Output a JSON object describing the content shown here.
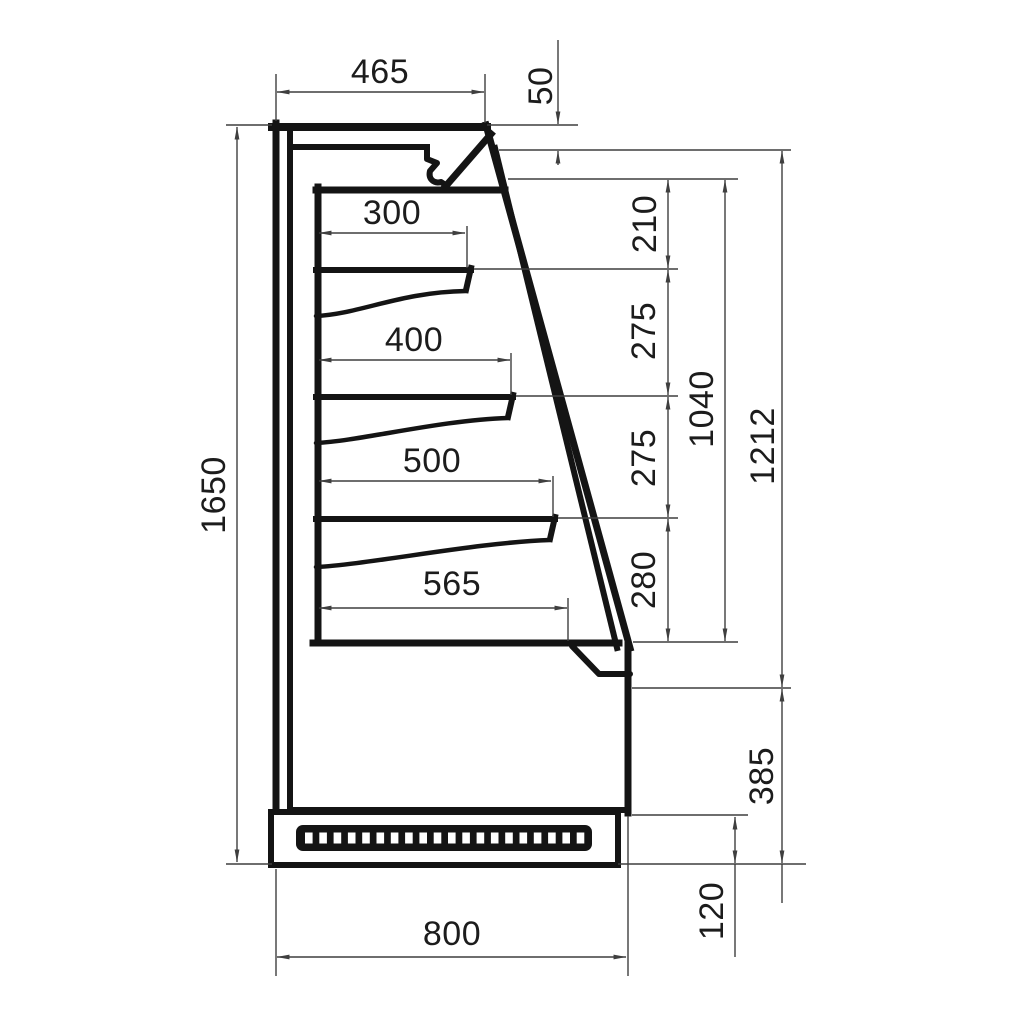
{
  "dims": {
    "top_depth": "465",
    "canopy_front_height": "50",
    "shelf_1_depth": "300",
    "shelf_2_depth": "400",
    "shelf_3_depth": "500",
    "deck_depth": "565",
    "spacing_top_to_shelf1": "210",
    "spacing_shelf1_to_shelf2": "275",
    "spacing_shelf2_to_shelf3": "275",
    "spacing_shelf3_to_deck": "280",
    "opening_height": "1040",
    "upper_front_height": "1212",
    "lower_front_height": "385",
    "plinth_height": "120",
    "overall_height": "1650",
    "overall_depth": "800"
  },
  "colors": {
    "outline": "#141414",
    "dimension": "#3f3f3f",
    "background": "#ffffff"
  }
}
